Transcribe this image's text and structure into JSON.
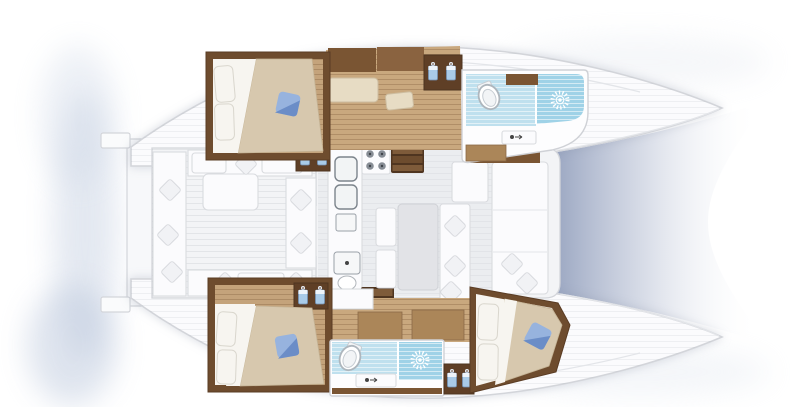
{
  "diagram": {
    "type": "catamaran-floor-plan",
    "orientation": "bow-right",
    "hulls": [
      {
        "position": "top",
        "rooms": [
          "aft-double-cabin",
          "lounge-corridor-with-wardrobe",
          "forward-bathroom-with-shower"
        ]
      },
      {
        "position": "bottom",
        "rooms": [
          "aft-double-cabin",
          "corridor",
          "mid-bathroom-with-shower",
          "forward-double-cabin"
        ]
      }
    ],
    "center": {
      "aft": "cockpit-with-table-and-bench-seating",
      "middle": "salon-with-galley-dining-table-and-sofa",
      "forward": "trampoline-between-bows"
    },
    "counts": {
      "cabins": 3,
      "bathrooms": 2,
      "double-beds": 3,
      "toilets": 2,
      "showers": 2,
      "stairways": 2,
      "wardrobe-hanger-pairs": 4,
      "stove_burners": 4,
      "galley_sink_basins": 2,
      "blue_pillows": 3,
      "white_pillows": 6,
      "cockpit_tables": 1,
      "dining_tables": 1,
      "sliding_door_arrows": 1
    }
  },
  "icons": [
    "toilet-icon",
    "shower-sunburst-icon",
    "hanger-icon",
    "stove-burners-icon",
    "sink-basin-icon",
    "faucet-icon",
    "sliding-door-arrow-icon",
    "cushion-icon",
    "stairs-icon"
  ],
  "colors": {
    "background": "#ffffff",
    "hull_fill": "#fbfbfd",
    "hull_stroke": "#d3d5da",
    "deck_fill": "#f3f4f6",
    "salon_floor": "#ebedf0",
    "wood_dark": "#6e4c2e",
    "wood_dark2": "#5f3f26",
    "wood_cab1": "#7a5533",
    "wood_cab2": "#8a6340",
    "wood_mid": "#c9a87e",
    "wood_floor": "#c4a37b",
    "wood_counter": "#ab8659",
    "bed_duvet": "#d7c8ae",
    "bed_sheet": "#f7f5f0",
    "pillow_blue_light": "#97b3de",
    "pillow_blue_dark": "#6b8dc7",
    "bath_tile": "#bfe0ee",
    "shower_tile": "#9fd2e7",
    "seat_bench": "#e7dcc4",
    "white_furniture": "#fbfbfd",
    "furniture_stroke": "#d9dbdf",
    "arrow_red": "#8e2f1f",
    "trampoline_blue": "#93a0bd",
    "hanger_blue": "#a9cbe8"
  }
}
